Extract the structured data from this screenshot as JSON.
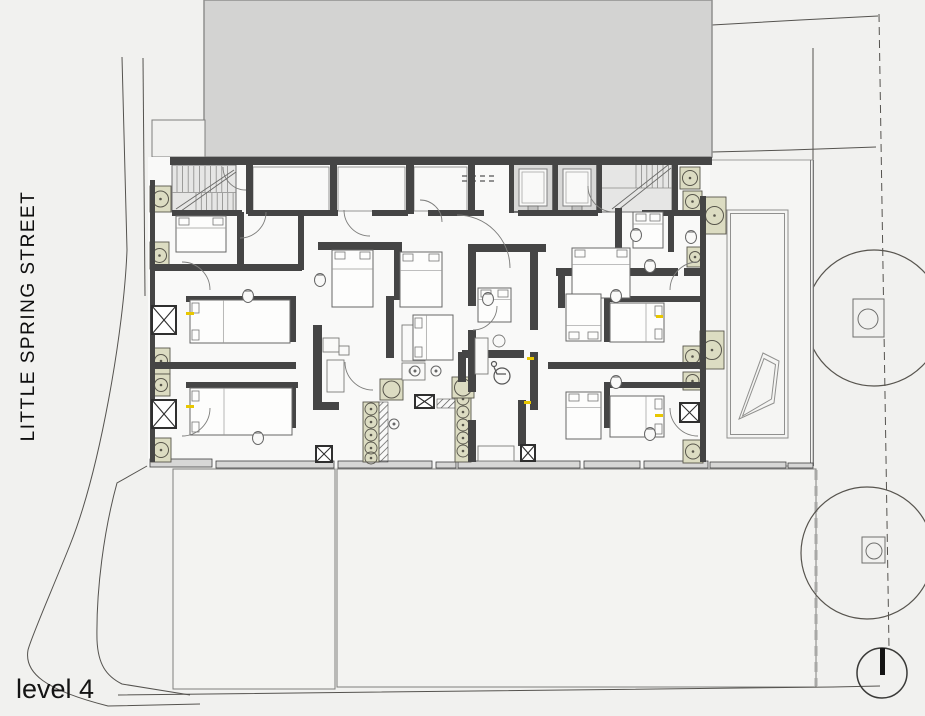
{
  "labels": {
    "street": "LITTLE SPRING STREET",
    "level": "level 4"
  },
  "colors": {
    "bg": "#f1f1ef",
    "paper": "#f9f9f8",
    "mass": "#d3d3d2",
    "massStroke": "#8f8f8e",
    "wall": "#454545",
    "lightFill": "#e0e0df",
    "lightStroke": "#6f6f6f",
    "thin": "#6f6f6f",
    "site": "#55534f",
    "roofLine": "#7f7f7d",
    "planter": "#dcdcc2",
    "planterStroke": "#58564c",
    "yellow": "#e8c700",
    "bandFill": "#d7d7d6",
    "bandStroke": "#3f3f3f",
    "treeStroke": "#57544e",
    "text": "#111111"
  },
  "site": {
    "mass": [
      204,
      0,
      508,
      157
    ],
    "notch": [
      152,
      120,
      53,
      37
    ],
    "paths": [
      "M122,57 L127,250 C124,330 100,470 70,545 C52,590 32,635 28,650 C24,673 45,690 108,706 L200,704",
      "M143,58 L145,296",
      "M147,466 L117,483 C104,530 96,590 97,640 C98,664 106,676 122,684 L190,695",
      "M118,695 L833,687 L880,686",
      "M712,25 L800,20 L878,16",
      "M712,152 L790,150 L876,147",
      "M813,48 L813,160"
    ],
    "dashedBoundary": {
      "path": "M879,14 L889,648",
      "dash": "8,5"
    },
    "roofEdgeDashed": {
      "path": "M816,470 L816,686",
      "dash": "10,6",
      "width": 3,
      "color": "#a8a8a6"
    },
    "roofRects": [
      [
        173,
        469,
        162,
        220
      ],
      [
        337,
        469,
        479,
        218
      ]
    ],
    "trees": [
      [
        874,
        318,
        68
      ],
      [
        867,
        553,
        66
      ]
    ],
    "treeSquares": [
      [
        853,
        299,
        31,
        38
      ],
      [
        862,
        537,
        23,
        26
      ]
    ],
    "treeSquareCircles": [
      [
        868,
        319,
        10
      ],
      [
        874,
        551,
        8
      ]
    ],
    "poleCircle": [
      882,
      673,
      25
    ],
    "poleBar": [
      880,
      648,
      5,
      27
    ]
  },
  "plan": {
    "paper": [
      148,
      157,
      562,
      310
    ],
    "terrace": {
      "bg": [
        706,
        160,
        107,
        306
      ],
      "eastLines": [
        [
          810.5,
          160,
          810.5,
          466
        ],
        [
          813.5,
          160,
          813.5,
          466
        ]
      ],
      "innerRects": [
        [
          727,
          210,
          61,
          228
        ],
        [
          730.5,
          213.5,
          54,
          221
        ]
      ],
      "quads": [
        "739,419 763,353 779,361 774,403",
        "742.5,416 764,358.5 775.5,364.5 771.5,399"
      ]
    },
    "band": [
      [
        150,
        459,
        62,
        8
      ],
      [
        216,
        461,
        118,
        7
      ],
      [
        338,
        461,
        94,
        7
      ],
      [
        436,
        462,
        20,
        6
      ],
      [
        458,
        461,
        122,
        7
      ],
      [
        584,
        461,
        56,
        7
      ],
      [
        644,
        461,
        64,
        7
      ],
      [
        710,
        462,
        76,
        6
      ],
      [
        788,
        463,
        25,
        5
      ]
    ],
    "walls": [
      [
        170,
        157,
        542,
        8
      ],
      [
        150,
        180,
        5,
        282
      ],
      [
        700,
        196,
        6,
        266
      ],
      [
        246,
        163,
        7,
        51
      ],
      [
        330,
        163,
        7,
        51
      ],
      [
        406,
        163,
        8,
        51
      ],
      [
        468,
        163,
        7,
        51
      ],
      [
        509,
        161,
        5,
        52
      ],
      [
        553,
        161,
        5,
        52
      ],
      [
        597,
        161,
        5,
        52
      ],
      [
        672,
        162,
        6,
        51
      ],
      [
        172,
        210,
        70,
        6
      ],
      [
        248,
        210,
        90,
        6
      ],
      [
        372,
        210,
        36,
        6
      ],
      [
        428,
        210,
        56,
        6
      ],
      [
        518,
        210,
        80,
        6
      ],
      [
        642,
        210,
        62,
        6
      ],
      [
        154,
        264,
        148,
        7
      ],
      [
        154,
        362,
        142,
        7
      ],
      [
        237,
        212,
        7,
        56
      ],
      [
        298,
        216,
        6,
        54
      ],
      [
        186,
        296,
        110,
        6
      ],
      [
        290,
        296,
        6,
        46
      ],
      [
        186,
        382,
        112,
        6
      ],
      [
        290,
        382,
        6,
        46
      ],
      [
        318,
        242,
        84,
        8
      ],
      [
        365,
        242,
        7,
        62
      ],
      [
        394,
        242,
        8,
        58
      ],
      [
        386,
        296,
        8,
        62
      ],
      [
        313,
        325,
        9,
        80
      ],
      [
        313,
        402,
        26,
        8
      ],
      [
        402,
        349,
        15,
        7
      ],
      [
        468,
        244,
        8,
        62
      ],
      [
        468,
        330,
        8,
        62
      ],
      [
        468,
        420,
        8,
        42
      ],
      [
        476,
        244,
        70,
        8
      ],
      [
        530,
        252,
        8,
        78
      ],
      [
        530,
        352,
        8,
        58
      ],
      [
        462,
        350,
        62,
        8
      ],
      [
        518,
        400,
        8,
        46
      ],
      [
        458,
        352,
        8,
        30
      ],
      [
        548,
        362,
        152,
        7
      ],
      [
        556,
        268,
        122,
        8
      ],
      [
        684,
        268,
        16,
        8
      ],
      [
        558,
        276,
        7,
        32
      ],
      [
        615,
        208,
        7,
        60
      ],
      [
        668,
        212,
        6,
        40
      ],
      [
        604,
        296,
        6,
        46
      ],
      [
        604,
        296,
        96,
        6
      ],
      [
        604,
        382,
        96,
        6
      ],
      [
        604,
        382,
        6,
        46
      ]
    ],
    "stairs": {
      "left": {
        "block": [
          172,
          165,
          64,
          47
        ],
        "v1": [
          177,
          5.6,
          10,
          166,
          192
        ],
        "landing": [
          172,
          192.5,
          236,
          192.5
        ],
        "v2": [
          196,
          5.3,
          8,
          193,
          211
        ],
        "diag": [
          [
            176,
            209,
            234,
            170
          ],
          [
            181,
            211,
            236,
            172
          ]
        ]
      },
      "right": {
        "block": [
          601,
          163,
          71,
          49
        ],
        "v1": [
          636,
          5.4,
          7,
          164,
          188
        ],
        "landing": [
          601,
          188,
          672,
          188
        ],
        "v2": [
          606,
          5.4,
          0,
          188,
          211
        ],
        "diag": [
          [
            612,
            209,
            668,
            165
          ],
          [
            617,
            211,
            671,
            168
          ]
        ]
      }
    },
    "lifts": [
      [
        513,
        164,
        40,
        48
      ],
      [
        557,
        164,
        40,
        48
      ]
    ],
    "serviceRooms": [
      [
        253,
        167,
        76,
        44
      ],
      [
        338,
        167,
        67,
        44
      ],
      [
        414,
        167,
        53,
        44
      ]
    ],
    "dashedLines": [
      [
        462,
        176,
        498,
        176
      ],
      [
        462,
        181,
        498,
        181
      ]
    ],
    "beds": [
      [
        176,
        216,
        50,
        36,
        "top"
      ],
      [
        190,
        300,
        100,
        43,
        "left"
      ],
      [
        190,
        388,
        102,
        47,
        "left"
      ],
      [
        332,
        250,
        41,
        57,
        "top"
      ],
      [
        400,
        252,
        42,
        55,
        "top"
      ],
      [
        413,
        315,
        40,
        45,
        "left"
      ],
      [
        572,
        248,
        58,
        50,
        "top"
      ],
      [
        610,
        303,
        54,
        39,
        "right"
      ],
      [
        566,
        294,
        35,
        47,
        "bottom"
      ],
      [
        610,
        396,
        54,
        41,
        "right"
      ],
      [
        566,
        392,
        35,
        47,
        "top"
      ],
      [
        633,
        212,
        30,
        36,
        "top"
      ],
      [
        478,
        288,
        33,
        34,
        "top"
      ]
    ],
    "toilets": [
      [
        248,
        296
      ],
      [
        320,
        280
      ],
      [
        258,
        438
      ],
      [
        650,
        266
      ],
      [
        616,
        296
      ],
      [
        650,
        434
      ],
      [
        488,
        299
      ],
      [
        636,
        235
      ],
      [
        691,
        237
      ],
      [
        616,
        382
      ]
    ],
    "sinks": [
      [
        415,
        371
      ],
      [
        436,
        371
      ],
      [
        394,
        424
      ]
    ],
    "wheelchair": {
      "wheel": [
        502,
        376,
        8
      ],
      "head": [
        494,
        364,
        2.5
      ],
      "body": "M494,367 L497,374 L506,374"
    },
    "planters": {
      "west": [
        [
          150,
          186,
          21,
          26
        ],
        [
          150,
          242,
          19,
          27
        ],
        [
          152,
          348,
          18,
          26
        ],
        [
          152,
          374,
          18,
          22
        ],
        [
          151,
          438,
          20,
          24
        ]
      ],
      "east": [
        [
          680,
          167,
          20,
          22
        ],
        [
          683,
          191,
          19,
          21
        ],
        [
          687,
          247,
          16,
          20
        ],
        [
          683,
          346,
          19,
          21
        ],
        [
          683,
          372,
          19,
          18
        ],
        [
          683,
          440,
          20,
          23
        ]
      ],
      "terraceBig": [
        [
          703,
          197,
          23,
          37
        ],
        [
          700,
          331,
          24,
          38
        ]
      ],
      "stripA": {
        "rect": [
          363,
          402,
          16,
          60
        ],
        "cx": 371,
        "cys": [
          409,
          422,
          435,
          448,
          458
        ],
        "r": 6
      },
      "stripB": {
        "rect": [
          455,
          378,
          16,
          84
        ],
        "cx": 463,
        "cys": [
          386,
          399,
          412,
          425,
          438,
          451
        ],
        "r": 6
      },
      "bigSquares": [
        [
          380,
          379,
          23,
          21
        ],
        [
          452,
          377,
          22,
          21
        ]
      ]
    },
    "xshafts": [
      [
        152,
        306,
        24,
        28
      ],
      [
        152,
        400,
        24,
        28
      ],
      [
        316,
        446,
        16,
        16
      ],
      [
        415,
        395,
        19,
        13
      ],
      [
        521,
        445,
        14,
        16
      ],
      [
        680,
        403,
        19,
        19
      ]
    ],
    "arcs": [
      "M266,212 A26 26 0 0 1 240,238",
      "M344,210 A26 26 0 0 0 370,236",
      "M457,215 A53 53 0 0 1 510,268",
      "M588,186 A26 26 0 0 0 614,212",
      "M182,262 A28 28 0 0 1 210,290",
      "M182,436 A28 28 0 0 0 210,408",
      "M345,362 A28 28 0 0 0 373,390",
      "M497,306 A24 24 0 0 1 473,330",
      "M698,262 A28 28 0 0 0 670,290",
      "M698,436 A28 28 0 0 1 670,408",
      "M246,190 A23 23 0 0 1 223,167",
      "M420,200 A22 22 0 0 1 442,222"
    ],
    "yellowTicks": [
      [
        186,
        312,
        8,
        3
      ],
      [
        186,
        405,
        8,
        3
      ],
      [
        527,
        357,
        7,
        3
      ],
      [
        524,
        401,
        7,
        3
      ],
      [
        656,
        315,
        7,
        3
      ],
      [
        655,
        414,
        8,
        3
      ]
    ],
    "hatches": [
      [
        377,
        402,
        11,
        60
      ],
      [
        437,
        399,
        20,
        9
      ]
    ],
    "furniture": [
      [
        323,
        338,
        16,
        14
      ],
      [
        339,
        346,
        10,
        9
      ],
      [
        327,
        360,
        17,
        32
      ],
      [
        402,
        325,
        23,
        36
      ],
      [
        402,
        363,
        23,
        17
      ],
      [
        478,
        446,
        36,
        15
      ],
      [
        475,
        338,
        13,
        36
      ],
      [
        635,
        213,
        12,
        9
      ],
      [
        649,
        213,
        12,
        9
      ]
    ],
    "furnitureCircles": [
      [
        499,
        341,
        6
      ],
      [
        412,
        371,
        3
      ]
    ]
  }
}
